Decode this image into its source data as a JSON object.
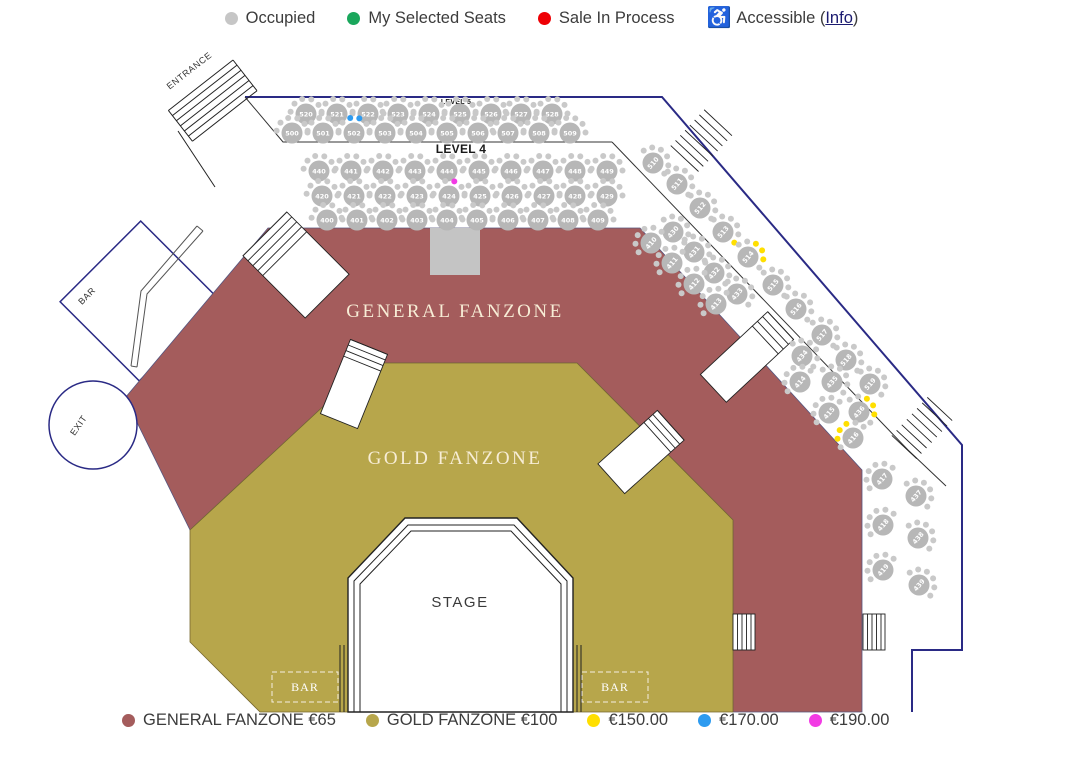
{
  "legend_top": {
    "items": [
      {
        "id": "occupied",
        "label": "Occupied",
        "color": "#c6c6c6"
      },
      {
        "id": "my-selected-seats",
        "label": "My Selected Seats",
        "color": "#1aa75c"
      },
      {
        "id": "sale-in-process",
        "label": "Sale In Process",
        "color": "#ee0005"
      }
    ],
    "accessible": {
      "label": "Accessible (",
      "link_label": "Info",
      "suffix": ")",
      "icon": "wheelchair-icon",
      "icon_color": "#1f6bd0"
    }
  },
  "legend_bottom": {
    "items": [
      {
        "id": "general-fanzone",
        "label": "GENERAL FANZONE €65",
        "color": "#a45c5c"
      },
      {
        "id": "gold-fanzone",
        "label": "GOLD FANZONE €100",
        "color": "#b7a64b"
      },
      {
        "id": "price-150",
        "label": "€150.00",
        "color": "#ffdf00"
      },
      {
        "id": "price-170",
        "label": "€170.00",
        "color": "#2d9bf0"
      },
      {
        "id": "price-190",
        "label": "€190.00",
        "color": "#f23be4"
      }
    ]
  },
  "map": {
    "labels": {
      "general_fanzone": "GENERAL FANZONE",
      "gold_fanzone": "GOLD FANZONE",
      "stage": "STAGE",
      "entrance": "ENTRANCE",
      "exit": "EXIT",
      "bar_left": "BAR",
      "bar_bottom_left": "BAR",
      "bar_bottom_right": "BAR",
      "level_4": "LEVEL 4",
      "level_5": "LEVEL 5"
    },
    "colors": {
      "general": "#a45c5c",
      "gold": "#b7a64b",
      "wall": "#2a2a85",
      "table": "#b7b7b7",
      "seat": "#c9c9c9",
      "seat_yellow": "#ffdf00",
      "seat_blue": "#2d9bf0",
      "seat_magenta": "#f23be4",
      "zone_label": "#f7edd6"
    },
    "tables": [
      {
        "n": "520",
        "x": 306,
        "y": 114
      },
      {
        "n": "521",
        "x": 337,
        "y": 114
      },
      {
        "n": "522",
        "x": 368,
        "y": 114
      },
      {
        "n": "523",
        "x": 398,
        "y": 114
      },
      {
        "n": "524",
        "x": 429,
        "y": 114
      },
      {
        "n": "525",
        "x": 460,
        "y": 114
      },
      {
        "n": "526",
        "x": 491,
        "y": 114
      },
      {
        "n": "527",
        "x": 521,
        "y": 114
      },
      {
        "n": "528",
        "x": 552,
        "y": 114
      },
      {
        "n": "500",
        "x": 292,
        "y": 133
      },
      {
        "n": "501",
        "x": 323,
        "y": 133
      },
      {
        "n": "502",
        "x": 354,
        "y": 133,
        "sc": {
          "2": "blue",
          "3": "blue"
        }
      },
      {
        "n": "503",
        "x": 385,
        "y": 133
      },
      {
        "n": "504",
        "x": 416,
        "y": 133
      },
      {
        "n": "505",
        "x": 447,
        "y": 133
      },
      {
        "n": "506",
        "x": 478,
        "y": 133
      },
      {
        "n": "507",
        "x": 508,
        "y": 133
      },
      {
        "n": "508",
        "x": 539,
        "y": 133
      },
      {
        "n": "509",
        "x": 570,
        "y": 133
      },
      {
        "n": "440",
        "x": 319,
        "y": 171
      },
      {
        "n": "441",
        "x": 351,
        "y": 171
      },
      {
        "n": "442",
        "x": 383,
        "y": 171
      },
      {
        "n": "443",
        "x": 415,
        "y": 171
      },
      {
        "n": "444",
        "x": 447,
        "y": 171
      },
      {
        "n": "445",
        "x": 479,
        "y": 171
      },
      {
        "n": "446",
        "x": 511,
        "y": 171
      },
      {
        "n": "447",
        "x": 543,
        "y": 171
      },
      {
        "n": "448",
        "x": 575,
        "y": 171
      },
      {
        "n": "449",
        "x": 607,
        "y": 171
      },
      {
        "n": "420",
        "x": 322,
        "y": 196
      },
      {
        "n": "421",
        "x": 354,
        "y": 196
      },
      {
        "n": "422",
        "x": 385,
        "y": 196
      },
      {
        "n": "423",
        "x": 417,
        "y": 196
      },
      {
        "n": "424",
        "x": 449,
        "y": 196,
        "sc": {
          "3": "magenta"
        }
      },
      {
        "n": "425",
        "x": 480,
        "y": 196
      },
      {
        "n": "426",
        "x": 512,
        "y": 196
      },
      {
        "n": "427",
        "x": 544,
        "y": 196
      },
      {
        "n": "428",
        "x": 575,
        "y": 196
      },
      {
        "n": "429",
        "x": 607,
        "y": 196
      },
      {
        "n": "400",
        "x": 327,
        "y": 220
      },
      {
        "n": "401",
        "x": 357,
        "y": 220
      },
      {
        "n": "402",
        "x": 387,
        "y": 220
      },
      {
        "n": "403",
        "x": 417,
        "y": 220
      },
      {
        "n": "404",
        "x": 447,
        "y": 220
      },
      {
        "n": "405",
        "x": 477,
        "y": 220
      },
      {
        "n": "406",
        "x": 508,
        "y": 220
      },
      {
        "n": "407",
        "x": 538,
        "y": 220
      },
      {
        "n": "408",
        "x": 568,
        "y": 220
      },
      {
        "n": "409",
        "x": 598,
        "y": 220
      },
      {
        "n": "510",
        "x": 653,
        "y": 163,
        "rot": -50,
        "sr": 45
      },
      {
        "n": "511",
        "x": 677,
        "y": 184,
        "rot": -50,
        "sr": 45
      },
      {
        "n": "512",
        "x": 700,
        "y": 208,
        "rot": -50,
        "sr": 45
      },
      {
        "n": "513",
        "x": 723,
        "y": 232,
        "rot": -50,
        "sr": 45,
        "sc": {
          "5": "yellow"
        }
      },
      {
        "n": "514",
        "x": 748,
        "y": 257,
        "rot": -50,
        "sr": 45,
        "sc": {
          "2": "yellow",
          "3": "yellow",
          "4": "yellow"
        }
      },
      {
        "n": "515",
        "x": 773,
        "y": 285,
        "rot": -50,
        "sr": 45
      },
      {
        "n": "516",
        "x": 796,
        "y": 309,
        "rot": -50,
        "sr": 45
      },
      {
        "n": "517",
        "x": 822,
        "y": 335,
        "rot": -50,
        "sr": 45
      },
      {
        "n": "518",
        "x": 846,
        "y": 360,
        "rot": -50,
        "sr": 45
      },
      {
        "n": "519",
        "x": 870,
        "y": 384,
        "rot": -50,
        "sr": 45
      },
      {
        "n": "430",
        "x": 673,
        "y": 232,
        "rot": -50,
        "sr": 45
      },
      {
        "n": "410",
        "x": 651,
        "y": 243,
        "rot": -50,
        "sr": -45
      },
      {
        "n": "431",
        "x": 694,
        "y": 252,
        "rot": -50,
        "sr": 45
      },
      {
        "n": "411",
        "x": 672,
        "y": 263,
        "rot": -50,
        "sr": -45
      },
      {
        "n": "432",
        "x": 714,
        "y": 273,
        "rot": -50,
        "sr": 45
      },
      {
        "n": "412",
        "x": 694,
        "y": 284,
        "rot": -50,
        "sr": -45
      },
      {
        "n": "433",
        "x": 737,
        "y": 294,
        "rot": -50,
        "sr": 45
      },
      {
        "n": "413",
        "x": 716,
        "y": 304,
        "rot": -50,
        "sr": -45
      },
      {
        "n": "434",
        "x": 802,
        "y": 356,
        "rot": -50,
        "sr": 45
      },
      {
        "n": "414",
        "x": 800,
        "y": 382,
        "rot": -50,
        "sr": -45
      },
      {
        "n": "435",
        "x": 832,
        "y": 382,
        "rot": -50,
        "sr": 45
      },
      {
        "n": "415",
        "x": 829,
        "y": 413,
        "rot": -50,
        "sr": -45
      },
      {
        "n": "436",
        "x": 859,
        "y": 412,
        "rot": -50,
        "sr": 45,
        "sc": {
          "2": "yellow",
          "3": "yellow",
          "4": "yellow"
        }
      },
      {
        "n": "416",
        "x": 853,
        "y": 438,
        "rot": -50,
        "sr": -45,
        "sc": {
          "1": "yellow",
          "2": "yellow",
          "3": "yellow"
        }
      },
      {
        "n": "437",
        "x": 916,
        "y": 496,
        "rot": -50,
        "sr": 45
      },
      {
        "n": "417",
        "x": 882,
        "y": 479,
        "rot": -50,
        "sr": -45
      },
      {
        "n": "438",
        "x": 918,
        "y": 538,
        "rot": -50,
        "sr": 45
      },
      {
        "n": "418",
        "x": 883,
        "y": 525,
        "rot": -50,
        "sr": -45
      },
      {
        "n": "439",
        "x": 919,
        "y": 585,
        "rot": -50,
        "sr": 45
      },
      {
        "n": "419",
        "x": 883,
        "y": 570,
        "rot": -50,
        "sr": -45
      }
    ]
  }
}
